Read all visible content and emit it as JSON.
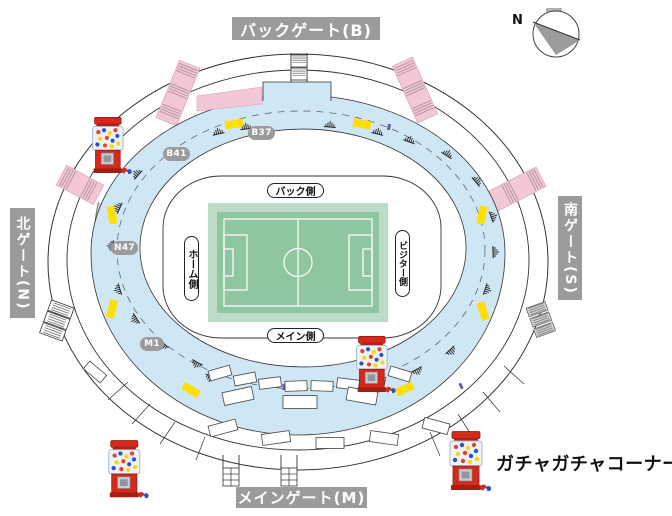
{
  "gates": {
    "back": "バックゲート(B)",
    "main": "メインゲート(M)",
    "north": "北ゲート(N)",
    "south": "南ゲート(S)"
  },
  "stand_sides": {
    "back": "バック側",
    "main": "メイン側",
    "home": "ホーム側",
    "visitor": "ビジター側"
  },
  "location_markers": {
    "b37": "B37",
    "b41": "B41",
    "n47": "N47",
    "m1": "M1"
  },
  "legend": {
    "gacha_corner_label": "ガチャガチャコーナー",
    "icon": "gacha-machine-icon"
  },
  "compass": {
    "north_label": "N"
  },
  "colors": {
    "concourse_blue": "#cfe6f5",
    "ramp_pink": "#f4c7d6",
    "shop_yellow": "#ffdf00",
    "pitch_green": "#8fc5a1",
    "pitch_border_green": "#bcdcc8",
    "gate_label_gray": "#9b9b9b",
    "marker_gray": "#9b9b9b",
    "gacha_red": "#d42a1e"
  }
}
